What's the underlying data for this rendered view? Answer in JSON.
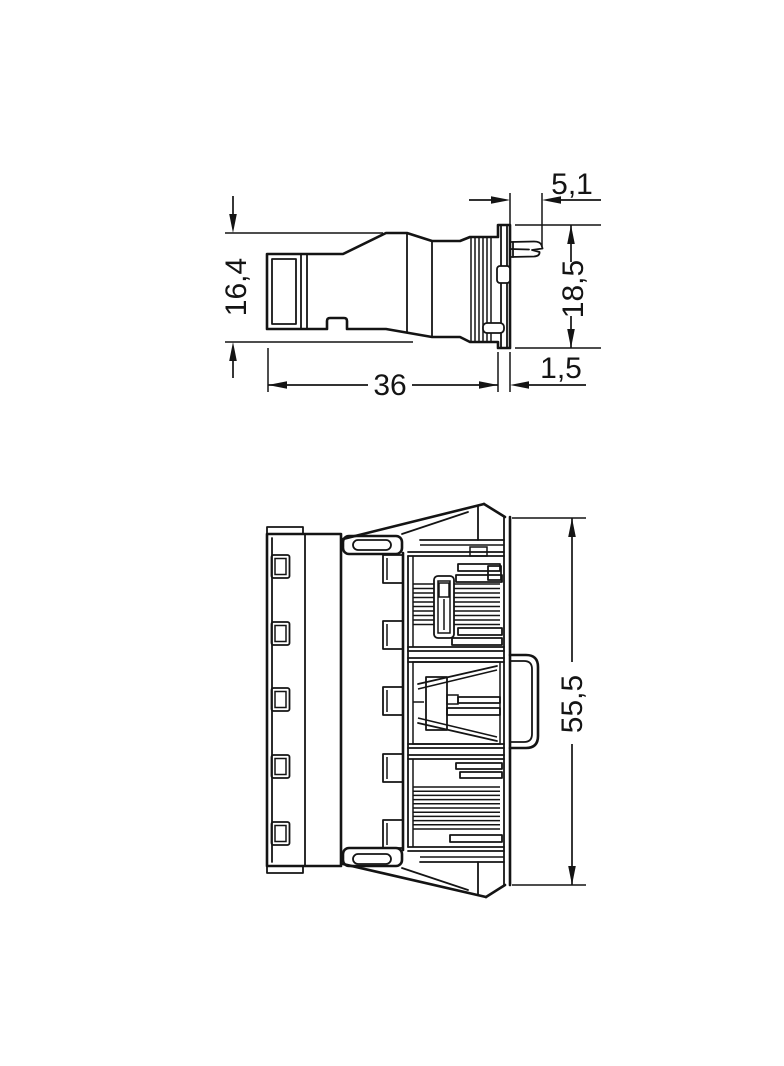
{
  "style": {
    "background": "#ffffff",
    "line_color": "#141414"
  },
  "views": {
    "side_view": {
      "dims": [
        {
          "label": "16,4"
        },
        {
          "label": "5,1"
        },
        {
          "label": "18,5"
        },
        {
          "label": "36"
        },
        {
          "label": "1,5"
        }
      ]
    },
    "front_view": {
      "dims": [
        {
          "label": "55,5"
        }
      ]
    }
  }
}
